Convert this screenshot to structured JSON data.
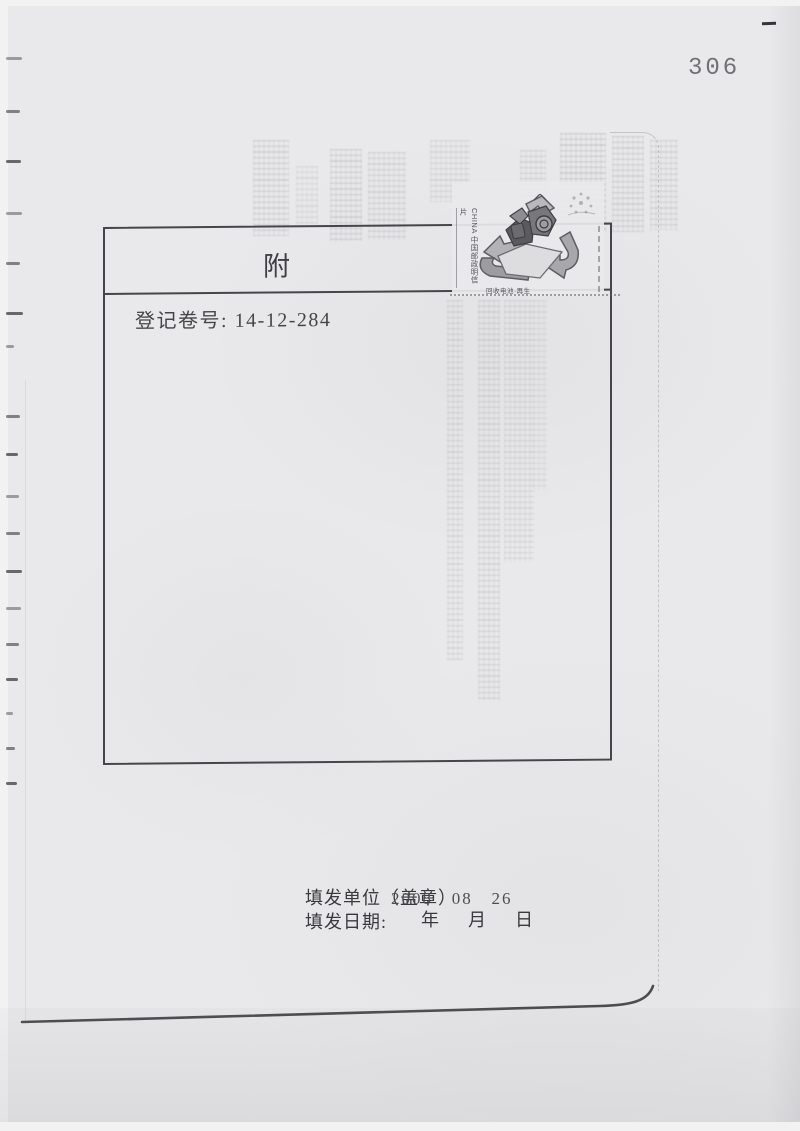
{
  "page": {
    "number": "306"
  },
  "box": {
    "title_left": "附",
    "title_right": "记",
    "register_label": "登记卷号:",
    "register_value": "14-12-284"
  },
  "stamp": {
    "country_line": "CHINA 中国邮政明信片",
    "caption": "回收电池·再生"
  },
  "footer": {
    "unit_label": "填发单位（盖章）",
    "date_stamp": "2008   08   26",
    "date_label": "填发日期:",
    "ymd_label": "年  月  日"
  },
  "colors": {
    "paper": "#e9e9eb",
    "ink": "#3f3f43",
    "border": "#46464a",
    "ghost": "#8d8d93"
  }
}
